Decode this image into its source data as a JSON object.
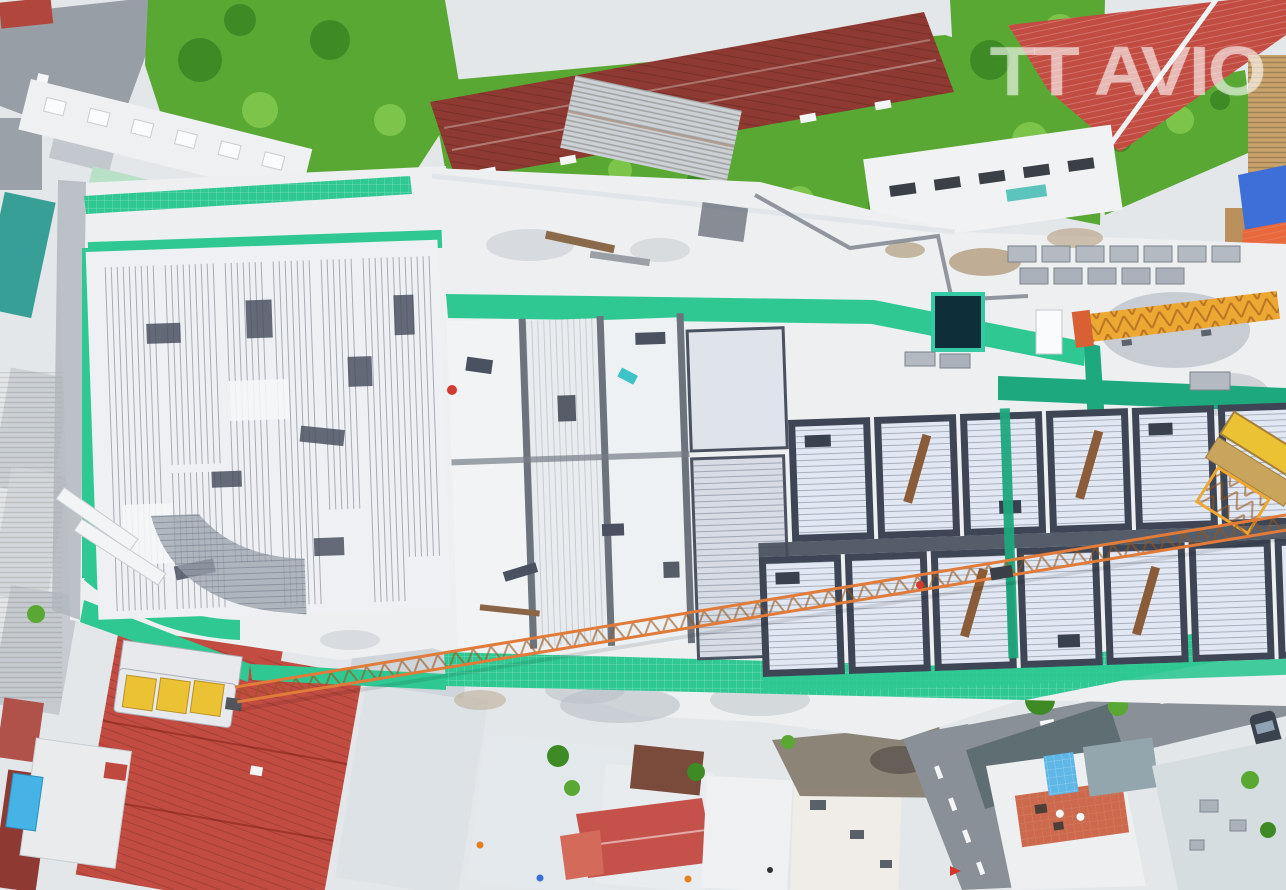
{
  "watermark": {
    "text": "TT AVIO"
  },
  "palette": {
    "base_concrete": "#e4e7ea",
    "site_concrete": "#edeff1",
    "netting": "#2fc893",
    "netting_dark": "#1ea87e",
    "veg": "#58a833",
    "veg_dark": "#3e8b26",
    "veg_light": "#7cc44a",
    "roof_red": "#c24c42",
    "roof_maroon": "#8e3a32",
    "roof_mint": "#b7e0c6",
    "roof_teal": "#379f95",
    "roof_grey": "#ccd2d7",
    "formwork": "#3e4656",
    "rebar_light": "#e2e8f3",
    "road": "#8a9097",
    "crane_orange": "#e07b3a",
    "crane_yellow": "#eda733",
    "counterweight": "#ecc235",
    "tarp_orange": "#e8683c",
    "tarp_blue": "#3e6fd9",
    "terrace": "#cd6a4e",
    "pool": "#45b3e6",
    "watermark_white": "rgba(255,255,255,0.55)"
  }
}
